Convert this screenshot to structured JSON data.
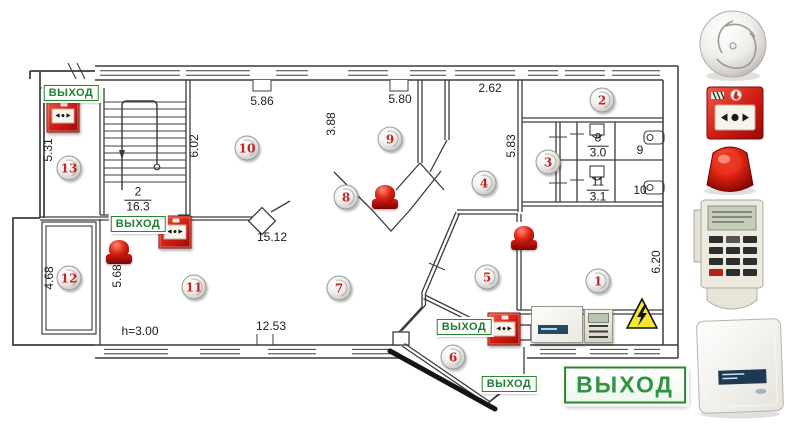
{
  "exit_sign": {
    "label": "ВЫХОД"
  },
  "colors": {
    "device_red": "#c41818",
    "exit_green": "#2e8b3a",
    "hazard_yellow": "#f2e636",
    "detector_number_red": "#c32424",
    "wall": "#3c3c3c"
  },
  "icons": {
    "call_point_glyph": "◄●►"
  },
  "plan": {
    "dimensions": [
      {
        "text": "5.86",
        "x": 262,
        "y": 101,
        "rot": 0
      },
      {
        "text": "5.80",
        "x": 400,
        "y": 99,
        "rot": 0
      },
      {
        "text": "2.62",
        "x": 490,
        "y": 88,
        "rot": 0
      },
      {
        "text": "3.88",
        "x": 331,
        "y": 124,
        "rot": 1
      },
      {
        "text": "6.02",
        "x": 194,
        "y": 146,
        "rot": 1
      },
      {
        "text": "5.31",
        "x": 48,
        "y": 150,
        "rot": 1
      },
      {
        "text": "5.83",
        "x": 511,
        "y": 146,
        "rot": 1
      },
      {
        "text": "15.12",
        "x": 272,
        "y": 237,
        "rot": 0
      },
      {
        "text": "5.68",
        "x": 117,
        "y": 276,
        "rot": 1
      },
      {
        "text": "4.68",
        "x": 49,
        "y": 278,
        "rot": 1
      },
      {
        "text": "12.53",
        "x": 271,
        "y": 326,
        "rot": 0
      },
      {
        "text": "h=3.00",
        "x": 140,
        "y": 331,
        "rot": 0
      },
      {
        "text": "6.20",
        "x": 656,
        "y": 262,
        "rot": 1
      }
    ],
    "room_labels": [
      {
        "number": "2",
        "area": "16.3",
        "x": 138,
        "y": 200
      },
      {
        "number": "8",
        "area": "3.0",
        "x": 598,
        "y": 146
      },
      {
        "number": "11",
        "area": "3.1",
        "x": 598,
        "y": 190
      },
      {
        "number": "9",
        "area": "",
        "x": 640,
        "y": 151
      },
      {
        "number": "10",
        "area": "",
        "x": 640,
        "y": 191
      }
    ],
    "detectors": [
      {
        "id": "1",
        "x": 598,
        "y": 281
      },
      {
        "id": "2",
        "x": 602,
        "y": 100
      },
      {
        "id": "3",
        "x": 548,
        "y": 162
      },
      {
        "id": "4",
        "x": 484,
        "y": 183
      },
      {
        "id": "5",
        "x": 487,
        "y": 277
      },
      {
        "id": "6",
        "x": 453,
        "y": 357
      },
      {
        "id": "7",
        "x": 339,
        "y": 288
      },
      {
        "id": "8",
        "x": 346,
        "y": 197
      },
      {
        "id": "9",
        "x": 390,
        "y": 139
      },
      {
        "id": "10",
        "x": 247,
        "y": 148
      },
      {
        "id": "11",
        "x": 194,
        "y": 287
      },
      {
        "id": "12",
        "x": 69,
        "y": 278
      },
      {
        "id": "13",
        "x": 69,
        "y": 168
      }
    ],
    "sirens": [
      {
        "x": 385,
        "y": 197
      },
      {
        "x": 524,
        "y": 238
      },
      {
        "x": 119,
        "y": 252
      }
    ],
    "call_points": [
      {
        "x": 63,
        "y": 116
      },
      {
        "x": 175,
        "y": 232
      },
      {
        "x": 504,
        "y": 329
      }
    ],
    "exit_signs": [
      {
        "x": 71,
        "y": 93,
        "large": false
      },
      {
        "x": 138,
        "y": 224,
        "large": false
      },
      {
        "x": 464,
        "y": 327,
        "large": false
      },
      {
        "x": 509,
        "y": 384,
        "large": false
      },
      {
        "x": 625,
        "y": 385,
        "large": true
      }
    ]
  },
  "equipment": {
    "cabinet": {
      "x": 531,
      "y": 306,
      "w": 50,
      "h": 35
    },
    "keypad": {
      "x": 584,
      "y": 309,
      "w": 27,
      "h": 32
    },
    "hazard_triangle": {
      "x": 626,
      "y": 297,
      "w": 32,
      "h": 34
    }
  },
  "legend": {
    "items": [
      {
        "name": "smoke-detector-icon"
      },
      {
        "name": "manual-call-point-icon"
      },
      {
        "name": "fire-siren-icon"
      },
      {
        "name": "control-keypad-icon"
      },
      {
        "name": "control-cabinet-icon"
      }
    ]
  }
}
